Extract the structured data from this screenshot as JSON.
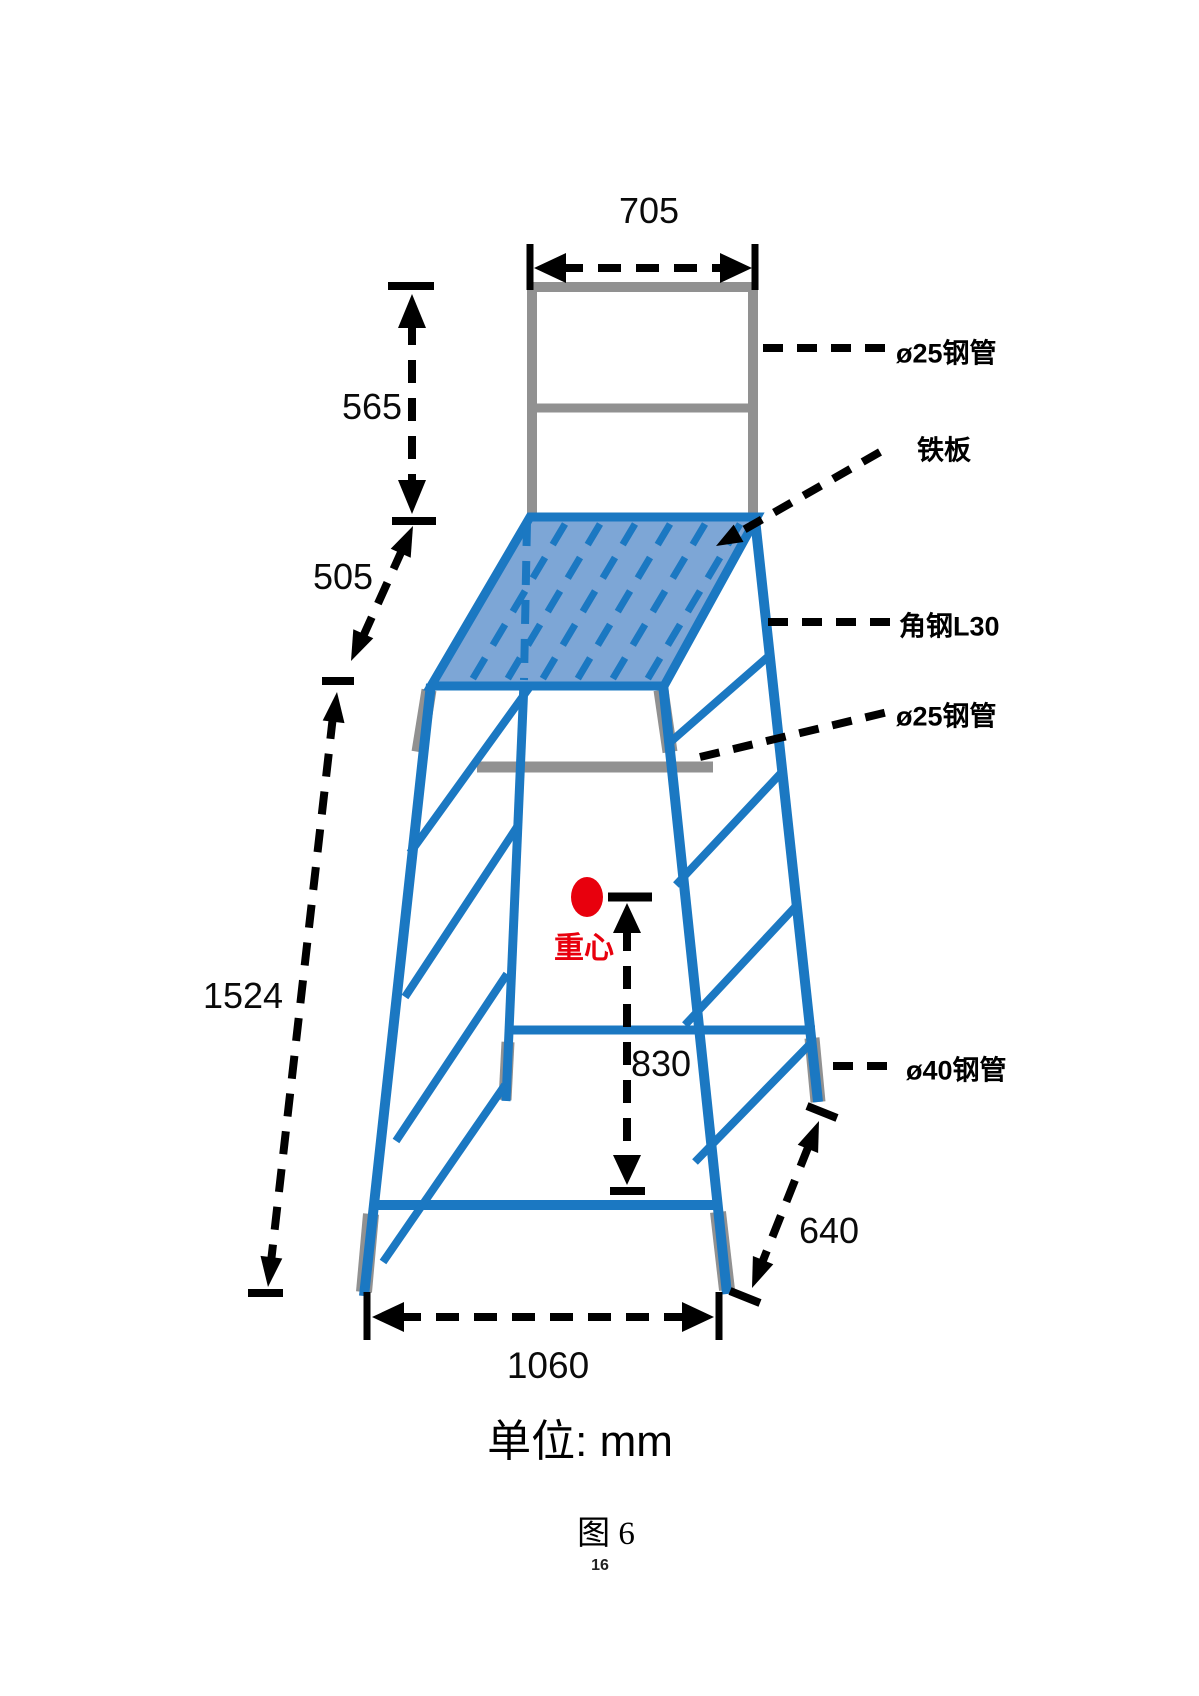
{
  "figure": {
    "unit_note": "单位: mm",
    "caption": "图 6",
    "page_number": "16"
  },
  "dimensions_mm": {
    "top_frame_width": "705",
    "guard_rail_height": "565",
    "platform_drop": "505",
    "overall_height": "1524",
    "cg_height": "830",
    "side_base_depth": "640",
    "front_base_width": "1060"
  },
  "part_labels": {
    "top_rail_pipe": "ø25钢管",
    "platform_plate": "铁板",
    "angle_steel": "角钢L30",
    "middle_pipe": "ø25钢管",
    "foot_pipe": "ø40钢管"
  },
  "annotations": {
    "center_of_gravity": "重心"
  },
  "colors": {
    "structure_blue": "#1b78c2",
    "plate_fill": "#7da6d6",
    "steel_gray": "#919191",
    "dimension_black": "#000000",
    "cg_red": "#e8000d"
  }
}
